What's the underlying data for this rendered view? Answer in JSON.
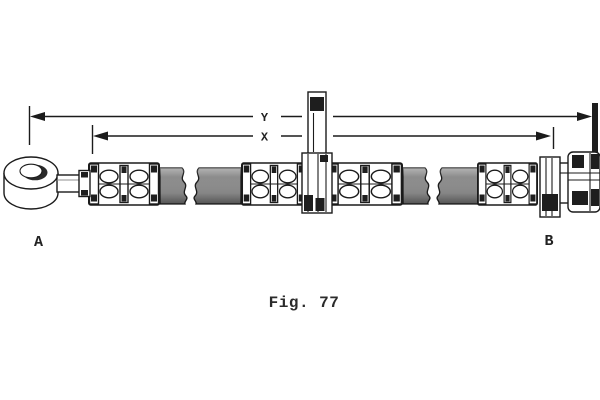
{
  "figure": {
    "caption": "Fig. 77",
    "type": "brake-hose-assembly-drawing"
  },
  "dimension_labels": {
    "y": "Y",
    "x": "X"
  },
  "end_labels": {
    "a": "A",
    "b": "B"
  },
  "colors": {
    "line": "#1b1b1b",
    "hose_gray": "#8c8c8c",
    "background": "#ffffff",
    "text": "#2b2b2b"
  }
}
